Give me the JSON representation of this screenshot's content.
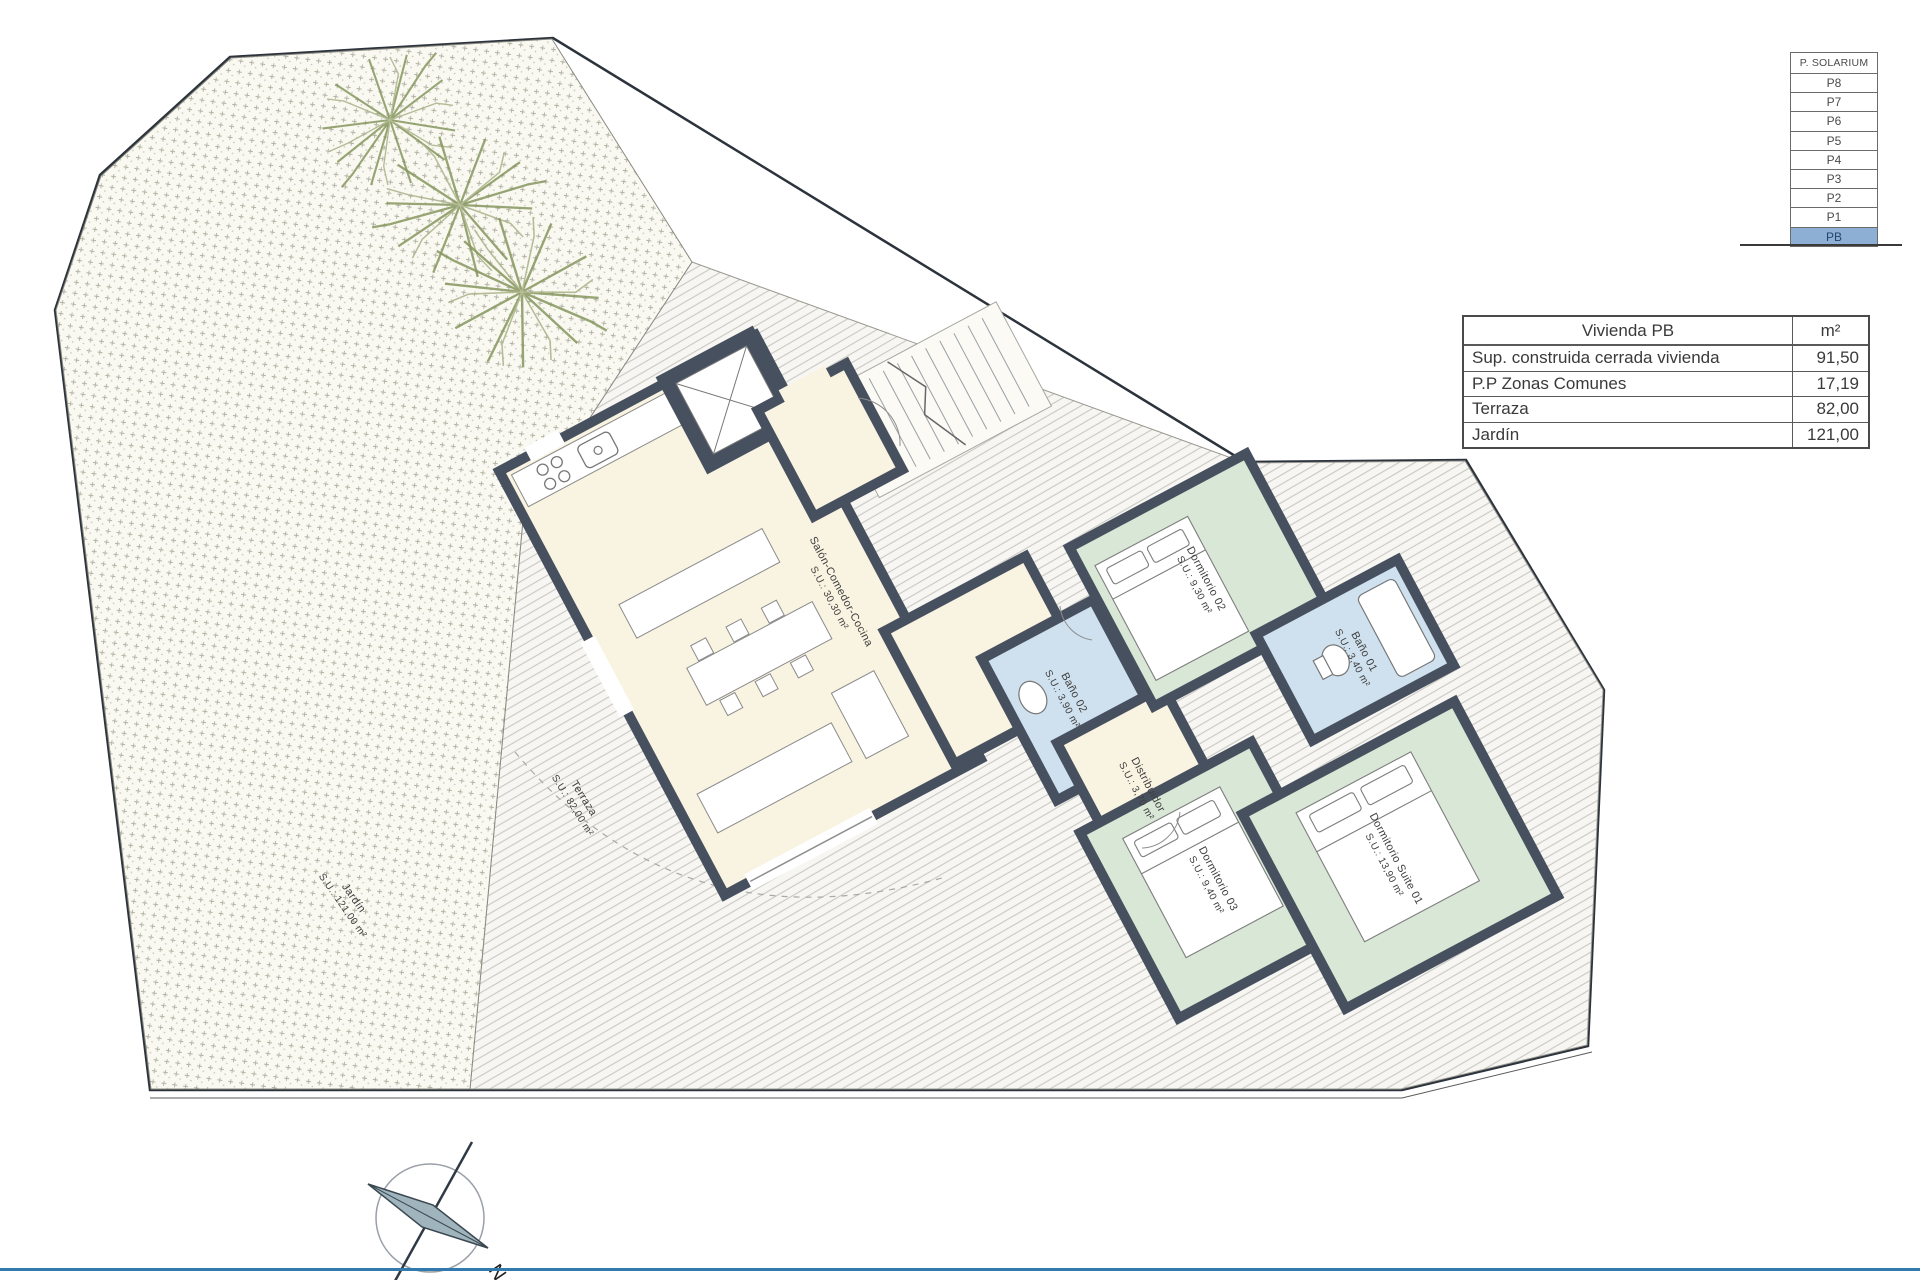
{
  "floor_selector": {
    "header": "P. SOLARIUM",
    "floors": [
      "P8",
      "P7",
      "P6",
      "P5",
      "P4",
      "P3",
      "P2",
      "P1",
      "PB"
    ],
    "active": "PB"
  },
  "area_table": {
    "title": "Vivienda PB",
    "unit_header": "m²",
    "rows": [
      {
        "label": "Sup. construida cerrada vivienda",
        "value": "91,50"
      },
      {
        "label": "P.P Zonas Comunes",
        "value": "17,19"
      },
      {
        "label": "Terraza",
        "value": "82,00"
      },
      {
        "label": "Jardín",
        "value": "121,00"
      }
    ]
  },
  "plan": {
    "rooms": [
      {
        "name": "Salón-Comedor-Cocina",
        "area": "S.U.: 30,30 m²"
      },
      {
        "name": "Dormitorio 02",
        "area": "S.U.: 9,30 m²"
      },
      {
        "name": "Baño 01",
        "area": "S.U.: 3,40 m²"
      },
      {
        "name": "Baño 02",
        "area": "S.U.: 3,90 m²"
      },
      {
        "name": "Distribuidor",
        "area": "S.U.: 3,70 m²"
      },
      {
        "name": "Dormitorio 03",
        "area": "S.U.: 9,40 m²"
      },
      {
        "name": "Dormitorio Suite 01",
        "area": "S.U.: 13,90 m²"
      }
    ],
    "outdoor": [
      {
        "name": "Terraza",
        "area": "S.U.: 82,00 m²"
      },
      {
        "name": "Jardín",
        "area": "S.U.: 121,00 m²"
      }
    ]
  },
  "compass": {
    "label": "N"
  },
  "colors": {
    "wall": "#47505e",
    "living_floor": "#f9f3e1",
    "bedroom_floor": "#d8e7d6",
    "bath_floor": "#cfe1ee",
    "pb_highlight": "#8dafd4",
    "accent_line": "#3279ad"
  }
}
